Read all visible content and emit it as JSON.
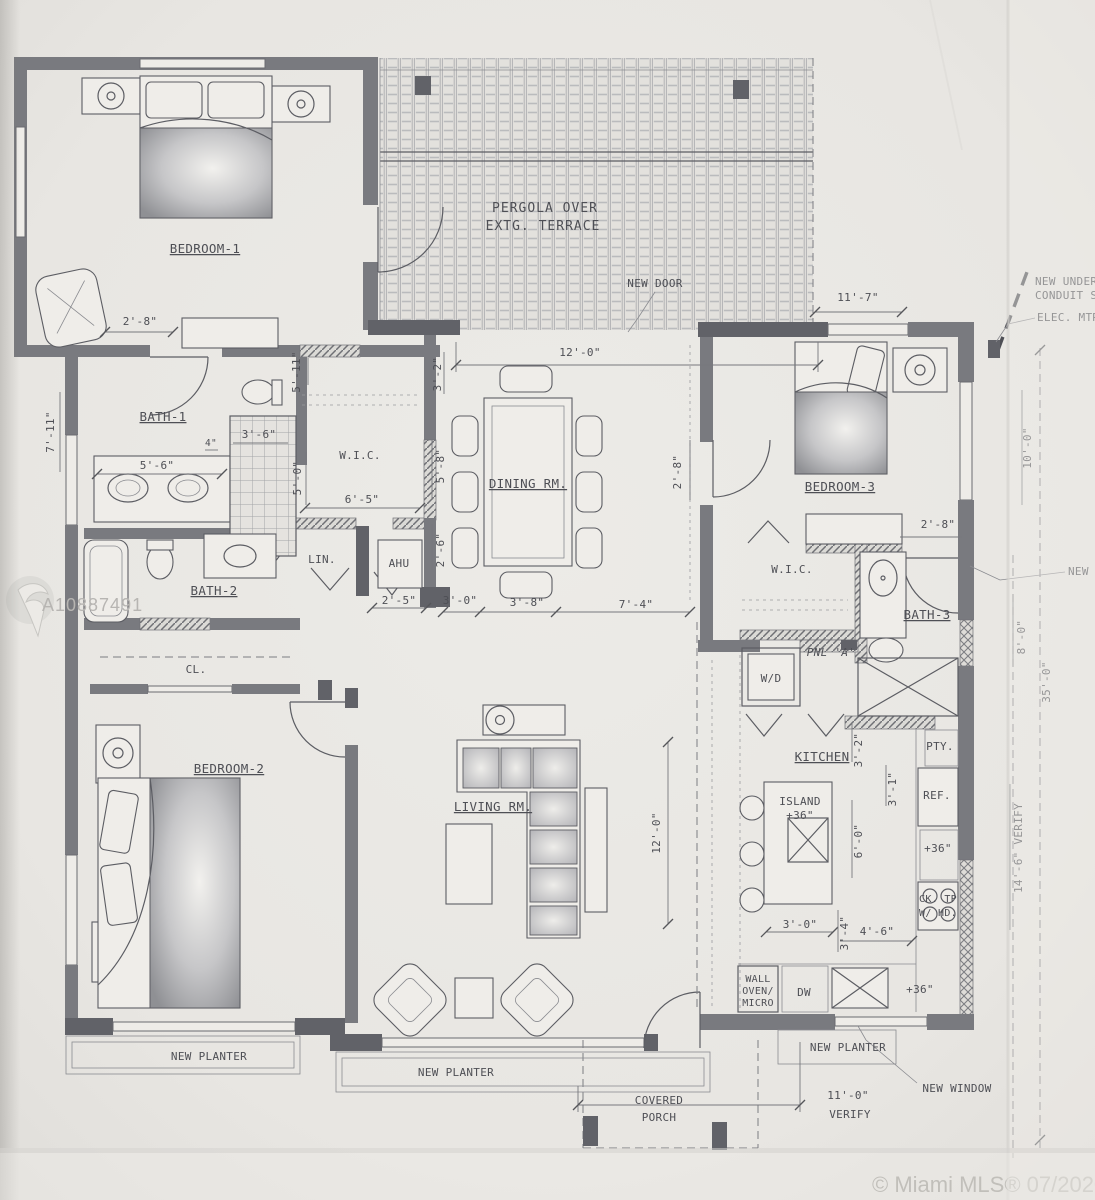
{
  "labels": {
    "bedroom1": "BEDROOM-1",
    "bedroom2": "BEDROOM-2",
    "bedroom3": "BEDROOM-3",
    "bath1": "BATH-1",
    "bath2": "BATH-2",
    "bath3": "BATH-3",
    "dining": "DINING RM.",
    "living": "LIVING RM.",
    "kitchen": "KITCHEN",
    "wic_left": "W.I.C.",
    "wic_right": "W.I.C.",
    "closet": "CL.",
    "linen": "LIN.",
    "ahu": "AHU",
    "wd": "W/D",
    "pantry": "PTY.",
    "fridge": "REF.",
    "dw": "DW",
    "island_1": "ISLAND",
    "island_2": "+36\"",
    "cooktop_1": "CK. TP",
    "cooktop_2": "W/ HD.",
    "wall_oven_1": "WALL",
    "wall_oven_2": "OVEN/",
    "wall_oven_3": "MICRO",
    "panel": "PNL 'A'",
    "pergola_1": "PERGOLA OVER",
    "pergola_2": "EXTG. TERRACE",
    "porch_1": "COVERED",
    "porch_2": "PORCH"
  },
  "annotations": {
    "new_door": "NEW DOOR",
    "new_window": "NEW WINDOW",
    "new_side": "NEW",
    "conduit_1": "NEW UNDER",
    "conduit_2": "CONDUIT S",
    "elec_meter": "ELEC. MTR",
    "planter_left": "NEW PLANTER",
    "planter_center": "NEW PLANTER",
    "planter_right": "NEW PLANTER",
    "counter_36_wall": "+36\"",
    "counter_36_bottom": "+36\""
  },
  "dimensions": {
    "bed1_door": "2'-8\"",
    "terrace": "12'-0\"",
    "bed3_top": "11'-7\"",
    "dining_n": "3'-2\"",
    "bath1_e": "5'-11\"",
    "west": "7'-11\"",
    "shower": "3'-6\"",
    "shower_jamb": "4\"",
    "vanity": "5'-6\"",
    "wic_l_d": "5'-0\"",
    "wic_l_w": "6'-5\"",
    "wic_l_e": "5'-8\"",
    "ahu_d": "2'-6\"",
    "hall": "2'-5\"",
    "dining_s1": "3'-0\"",
    "dining_s2": "3'-8\"",
    "dining_s3": "7'-4\"",
    "dining_e": "2'-8\"",
    "bath3_top": "2'-8\"",
    "bed3_e": "10'-0\"",
    "right_8": "8'-0\"",
    "right_35": "35'-0\"",
    "right_14": "14'-6\" VERIFY",
    "living_d": "12'-0\"",
    "kitchen_n": "3'-2\"",
    "ref_w": "3'-1\"",
    "island_e": "6'-0\"",
    "island_s": "3'-0\"",
    "kitchen_s1": "3'-4\"",
    "kitchen_s2": "4'-6\"",
    "porch_w": "11'-0\"",
    "porch_verify": "VERIFY"
  },
  "watermark": {
    "listing_id": "A10887491",
    "copyright": "© Miami MLS® 07/2020"
  }
}
